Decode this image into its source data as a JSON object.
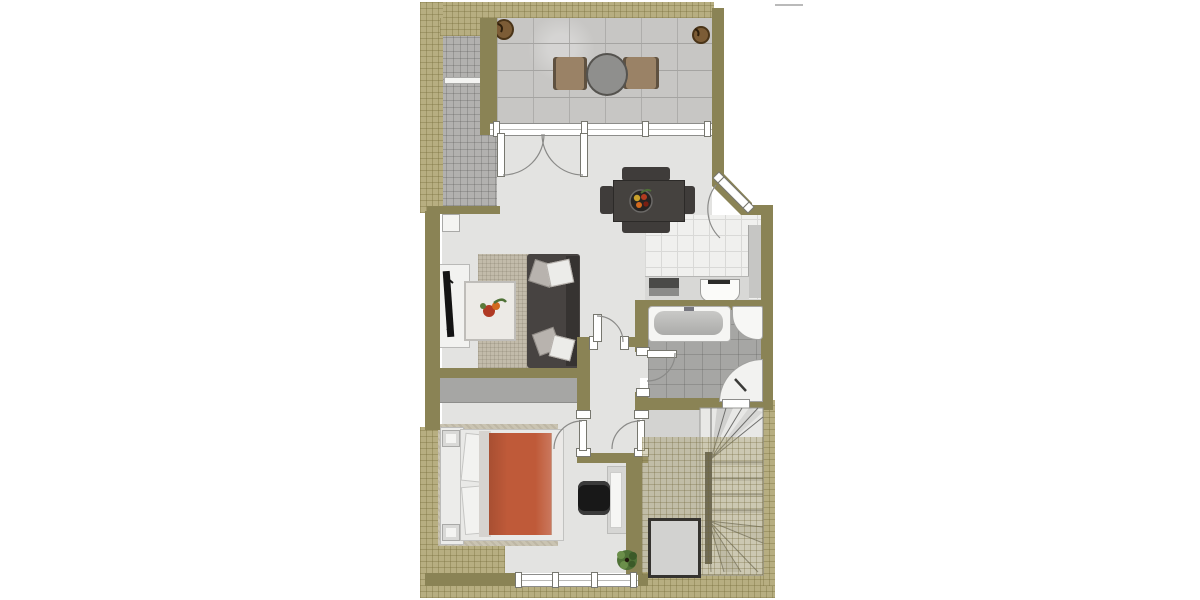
{
  "floorplan": {
    "title_visible": false,
    "watermark_text": "",
    "colors": {
      "wall": "#8a8355",
      "roof_hatch": "#b7ae81",
      "interior_floor": "#e3e3e1",
      "terrace_tile": "#c7c6c4",
      "balcony_strip_tile": "#b2b1af",
      "kitchen_tile": "#f0f0ee",
      "bathroom_tile": "#a6a6a4",
      "stair_floor": "#d3d3d1",
      "sofa": "#474341",
      "living_rug": "#c2bbaa",
      "bed_duvet": "#bf5a39",
      "dining_set": "#3f3c3a",
      "terrace_chair": "#9a8266",
      "wardrobe": "#a6a6a4",
      "plant_pot": "#7c5c36",
      "plant_green": "#557536"
    },
    "rooms": [
      {
        "id": "terrace",
        "furniture": [
          "round-table",
          "terrace-chair-left",
          "terrace-chair-right",
          "plant-pot-left",
          "plant-pot-right"
        ]
      },
      {
        "id": "side-balcony-strip",
        "furniture": [
          "ledge"
        ]
      },
      {
        "id": "living-room",
        "furniture": [
          "sofa",
          "sofa-cushions",
          "coffee-table",
          "area-rug",
          "tv-board",
          "tv",
          "dining-table",
          "dining-chairs",
          "fruit-bowl"
        ]
      },
      {
        "id": "kitchen",
        "furniture": [
          "kitchen-counter",
          "cooktop",
          "kitchen-sink",
          "side-counter"
        ]
      },
      {
        "id": "bathroom",
        "furniture": [
          "bathtub",
          "corner-washbasin",
          "corner-shower"
        ]
      },
      {
        "id": "hallway",
        "furniture": []
      },
      {
        "id": "bedroom",
        "furniture": [
          "wardrobe",
          "bed-rug",
          "headboard-shelf",
          "nightstand-top",
          "nightstand-bottom",
          "pillows",
          "duvet",
          "desk",
          "office-chair",
          "potted-plant"
        ]
      },
      {
        "id": "stair-landing",
        "furniture": []
      },
      {
        "id": "stairwell",
        "furniture": [
          "winder-staircase",
          "stair-spine-wall",
          "floor-opening"
        ]
      }
    ],
    "doors": [
      "terrace-french-double-door",
      "entry-door-diagonal",
      "hall-living-door",
      "bathroom-door",
      "bedroom-door",
      "stair-landing-door"
    ],
    "windows": [
      "terrace-window-band",
      "bedroom-south-window",
      "bathroom-south-window"
    ]
  }
}
